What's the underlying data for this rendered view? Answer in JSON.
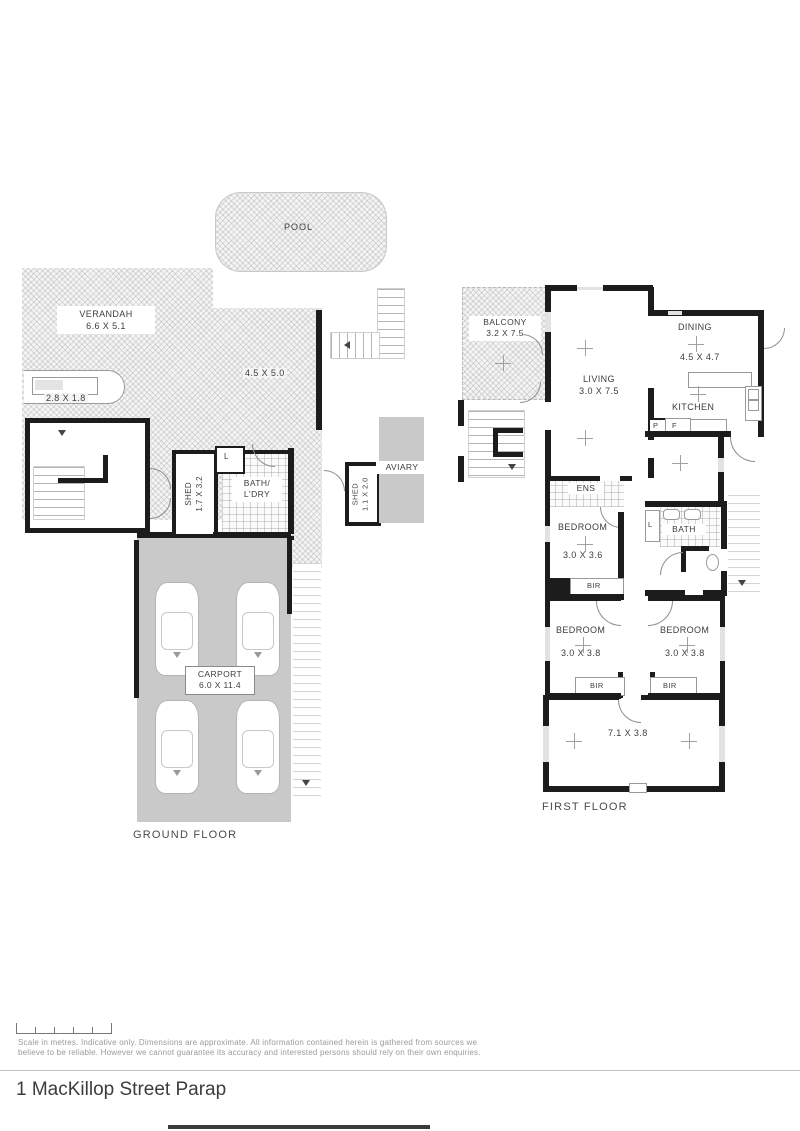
{
  "page": {
    "title": "1 MacKillop Street Parap",
    "disclaimer_line1": "Scale in metres. Indicative only. Dimensions are approximate. All information contained herein is gathered from sources we",
    "disclaimer_line2": "believe to be reliable. However we cannot guarantee its accuracy and interested persons should rely on their own enquiries."
  },
  "ground": {
    "floor_label": "GROUND FLOOR",
    "pool_label": "POOL",
    "verandah_name": "VERANDAH",
    "verandah_dim": "6.6 X 5.1",
    "deck_dim": "4.5 X 5.0",
    "ramp_dim": "2.8 X 1.8",
    "shed1_name": "SHED",
    "shed1_dim": "1.7 X 3.2",
    "bath_line1": "BATH/",
    "bath_line2": "L'DRY",
    "laundry_linen_label": "L",
    "shed2_name": "SHED",
    "shed2_dim": "1.1 X 2.0",
    "aviary_label": "AVIARY",
    "carport_name": "CARPORT",
    "carport_dim": "6.0 X 11.4"
  },
  "first": {
    "floor_label": "FIRST FLOOR",
    "balcony_name": "BALCONY",
    "balcony_dim": "3.2 X 7.5",
    "living_name": "LIVING",
    "living_dim": "3.0 X 7.5",
    "dining_name": "DINING",
    "dining_dim": "4.5 X 4.7",
    "kitchen_label": "KITCHEN",
    "pantry_label": "P",
    "fridge_label": "F",
    "ens_label": "ENS",
    "bedroom_label": "BEDROOM",
    "bed1_dim": "3.0 X 3.6",
    "bir_label": "BIR",
    "bath_label": "BATH",
    "linen_label": "L",
    "bed2_dim": "3.0 X 3.8",
    "bed3_dim": "3.0 X 3.8",
    "rumpus_dim": "7.1 X 3.8"
  }
}
